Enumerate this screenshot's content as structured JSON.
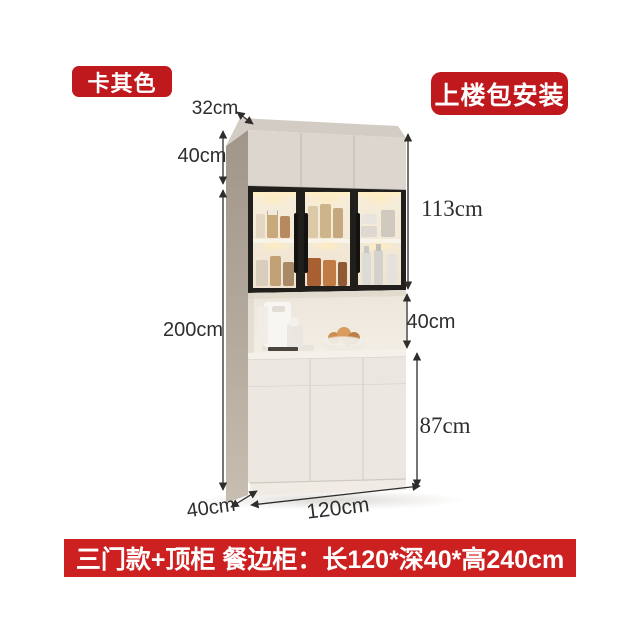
{
  "badges": {
    "color_label": "卡其色",
    "service_label": "上楼包安装"
  },
  "banner": {
    "text": "三门款+顶柜 餐边柜：长120*深40*高240cm"
  },
  "dimensions": {
    "top_depth": "32cm",
    "top_cabinet_height": "40cm",
    "total_height": "200cm",
    "glass_cabinet_height": "113cm",
    "open_shelf_height": "40cm",
    "base_cabinet_height": "87cm",
    "base_depth": "40cm",
    "width": "120cm"
  },
  "colors": {
    "badge_red": "#bf181d",
    "banner_red": "#cd2020",
    "cabinet_front": "#dcd6ce",
    "cabinet_side": "#a59a8c",
    "lower_front": "#ece8e1",
    "glass_frame": "#211f1c",
    "warm_glow": "#ffe9b8",
    "dimension_line": "#2e2d2b"
  }
}
